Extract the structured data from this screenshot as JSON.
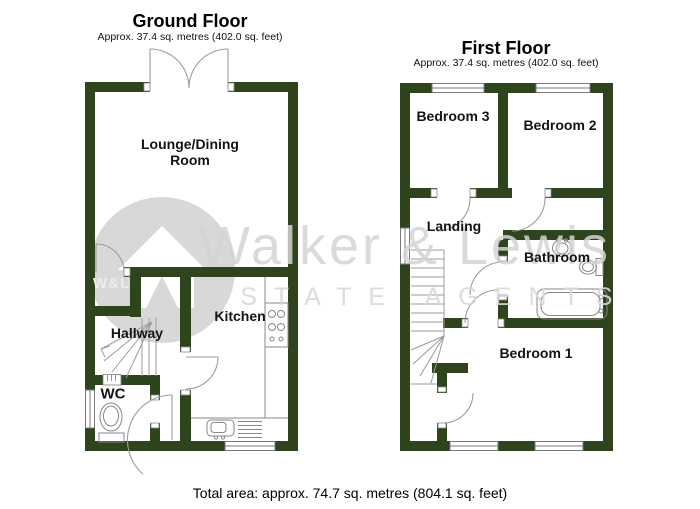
{
  "colors": {
    "wall": "#2e441c",
    "door_line": "#9b9b9b",
    "fixture_line": "#878787",
    "watermark_gray": "#d8d8d8",
    "label_text": "#141414"
  },
  "ground_floor": {
    "title": "Ground Floor",
    "subtitle": "Approx. 37.4 sq. metres (402.0 sq. feet)",
    "rooms": {
      "lounge": "Lounge/Dining\nRoom",
      "hallway": "Hallway",
      "wc": "WC",
      "kitchen": "Kitchen"
    }
  },
  "first_floor": {
    "title": "First Floor",
    "subtitle": "Approx. 37.4 sq. metres (402.0 sq. feet)",
    "rooms": {
      "bedroom3": "Bedroom 3",
      "bedroom2": "Bedroom 2",
      "landing": "Landing",
      "bathroom": "Bathroom",
      "bedroom1": "Bedroom 1"
    }
  },
  "watermark": {
    "brand": "Walker & Lewis",
    "tagline": "ESTATE AGENTS",
    "monogram": "W&L"
  },
  "footer": {
    "total_area": "Total area: approx. 74.7 sq. metres (804.1 sq. feet)"
  }
}
